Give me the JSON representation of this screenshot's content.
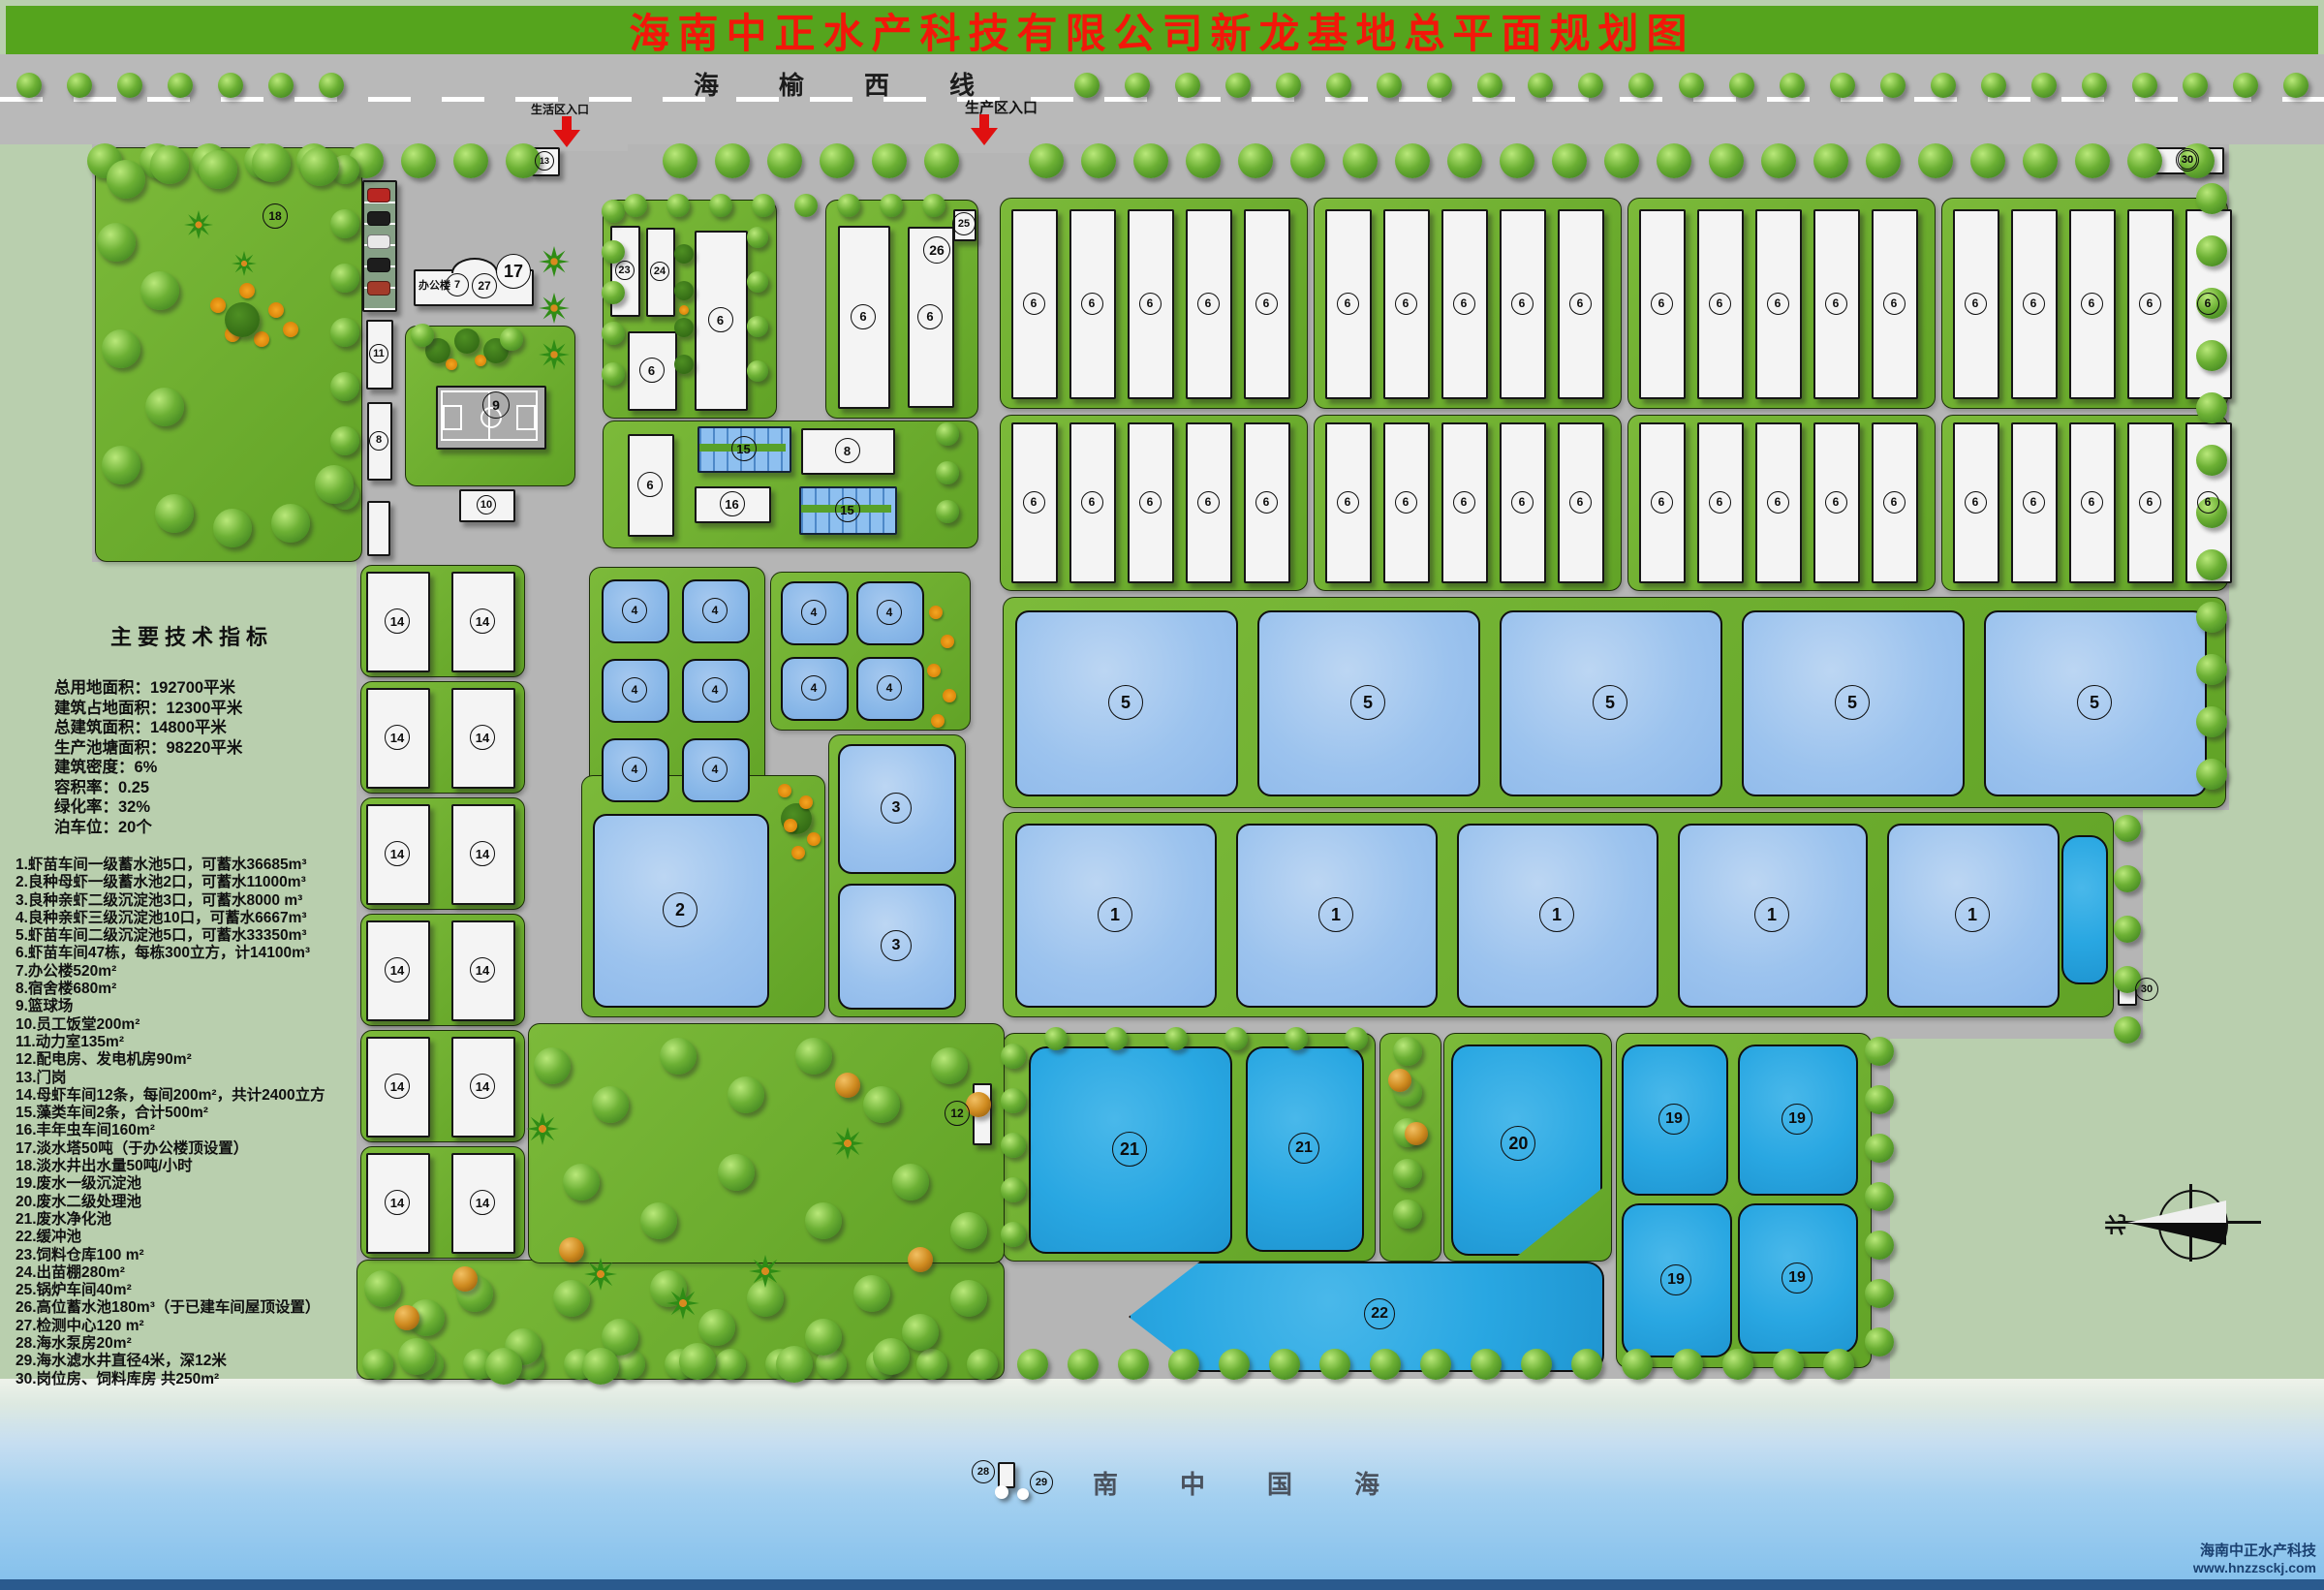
{
  "title": "海南中正水产科技有限公司新龙基地总平面规划图",
  "highway": {
    "name": "海榆西线"
  },
  "entrances": [
    {
      "label": "生活区入口"
    },
    {
      "label": "生产区入口"
    }
  ],
  "indicators": {
    "title": "主要技术指标",
    "lines": [
      "总用地面积：192700平米",
      "建筑占地面积：12300平米",
      "总建筑面积：14800平米",
      "生产池塘面积：98220平米",
      "建筑密度：6%",
      "容积率：0.25",
      "绿化率：32%",
      "泊车位：20个"
    ]
  },
  "legend": [
    "1.虾苗车间一级蓄水池5口，可蓄水36685m³",
    "2.良种母虾一级蓄水池2口，可蓄水11000m³",
    "3.良种亲虾二级沉淀池3口，可蓄水8000 m³",
    "4.良种亲虾三级沉淀池10口，可蓄水6667m³",
    "5.虾苗车间二级沉淀池5口，可蓄水33350m³",
    "6.虾苗车间47栋，每栋300立方，计14100m³",
    "7.办公楼520m²",
    "8.宿舍楼680m²",
    "9.篮球场",
    "10.员工饭堂200m²",
    "11.动力室135m²",
    "12.配电房、发电机房90m²",
    "13.门岗",
    "14.母虾车间12条，每间200m²，共计2400立方",
    "15.藻类车间2条，合计500m²",
    "16.丰年虫车间160m²",
    "17.淡水塔50吨（于办公楼顶设置）",
    "18.淡水井出水量50吨/小时",
    "19.废水一级沉淀池",
    "20.废水二级处理池",
    "21.废水净化池",
    "22.缓冲池",
    "23.饲料仓库100 m²",
    "24.出苗棚280m²",
    "25.锅炉车间40m²",
    "26.高位蓄水池180m³（于已建车间屋顶设置）",
    "27.检测中心120 m²",
    "28.海水泵房20m²",
    "29.海水滤水井直径4米，深12米",
    "30.岗位房、饲料库房 共250m²"
  ],
  "sea_label": "南中国海",
  "compass_label": "北",
  "watermark": {
    "company": "海南中正水产科技",
    "url": "www.hnzzsckj.com"
  },
  "office_text": "办公楼",
  "plan": {
    "islands": [
      [
        98,
        152,
        274,
        426
      ],
      [
        418,
        336,
        174,
        164
      ],
      [
        622,
        206,
        178,
        224
      ],
      [
        852,
        206,
        156,
        224
      ],
      [
        622,
        434,
        386,
        130
      ],
      [
        608,
        585,
        180,
        252
      ],
      [
        795,
        590,
        205,
        162
      ],
      [
        600,
        800,
        250,
        248
      ],
      [
        855,
        758,
        140,
        290
      ],
      [
        1035,
        616,
        1261,
        216
      ],
      [
        1035,
        838,
        1145,
        210
      ],
      [
        1035,
        1066,
        383,
        234
      ],
      [
        1424,
        1066,
        62,
        234
      ],
      [
        1490,
        1066,
        172,
        234
      ],
      [
        1668,
        1066,
        262,
        344
      ],
      [
        368,
        1300,
        667,
        122
      ],
      [
        545,
        1056,
        490,
        246
      ]
    ],
    "workshops": {
      "xs": [
        1032,
        1356,
        1680,
        2004
      ],
      "n": 5,
      "pitch": 60,
      "inset": 12,
      "w": 44,
      "rows": [
        [
          216,
          192
        ],
        [
          436,
          162
        ]
      ],
      "label": "6"
    },
    "grid14": {
      "cols": [
        378,
        466
      ],
      "w": 62,
      "h": 100,
      "rows": [
        590,
        710,
        830,
        950,
        1070,
        1190
      ],
      "label": "14"
    },
    "ponds": [
      [
        621,
        598,
        66,
        62,
        "4",
        "M"
      ],
      [
        704,
        598,
        66,
        62,
        "4",
        "M"
      ],
      [
        621,
        680,
        66,
        62,
        "4",
        "M"
      ],
      [
        704,
        680,
        66,
        62,
        "4",
        "M"
      ],
      [
        621,
        762,
        66,
        62,
        "4",
        "M"
      ],
      [
        704,
        762,
        66,
        62,
        "4",
        "M"
      ],
      [
        806,
        600,
        66,
        62,
        "4",
        "M"
      ],
      [
        884,
        600,
        66,
        62,
        "4",
        "M"
      ],
      [
        806,
        678,
        66,
        62,
        "4",
        "M"
      ],
      [
        884,
        678,
        66,
        62,
        "4",
        "M"
      ],
      [
        612,
        840,
        178,
        196,
        "2",
        "L"
      ],
      [
        865,
        768,
        118,
        130,
        "3",
        "L"
      ],
      [
        865,
        912,
        118,
        126,
        "3",
        "L"
      ],
      [
        1048,
        630,
        226,
        188,
        "5",
        "L"
      ],
      [
        1298,
        630,
        226,
        188,
        "5",
        "L"
      ],
      [
        1548,
        630,
        226,
        188,
        "5",
        "L"
      ],
      [
        1798,
        630,
        226,
        188,
        "5",
        "L"
      ],
      [
        2048,
        630,
        226,
        188,
        "5",
        "L"
      ],
      [
        1048,
        850,
        204,
        186,
        "1",
        "L"
      ],
      [
        1276,
        850,
        204,
        186,
        "1",
        "L"
      ],
      [
        1504,
        850,
        204,
        186,
        "1",
        "L"
      ],
      [
        1732,
        850,
        192,
        186,
        "1",
        "L"
      ],
      [
        1948,
        850,
        174,
        186,
        "1",
        "L"
      ],
      [
        2128,
        862,
        44,
        150,
        "",
        "C"
      ],
      [
        1062,
        1080,
        206,
        210,
        "21",
        "C"
      ],
      [
        1286,
        1080,
        118,
        208,
        "21",
        "C"
      ],
      [
        1498,
        1078,
        152,
        214,
        "20",
        "C",
        "p20"
      ],
      [
        1674,
        1078,
        106,
        152,
        "19",
        "C"
      ],
      [
        1794,
        1078,
        120,
        152,
        "19",
        "C"
      ],
      [
        1674,
        1242,
        110,
        155,
        "19",
        "C"
      ],
      [
        1794,
        1242,
        120,
        151,
        "19",
        "C"
      ],
      [
        1165,
        1302,
        487,
        110,
        "22",
        "C",
        "p22"
      ]
    ],
    "buildings": [
      [
        374,
        186,
        32,
        132,
        "",
        "park"
      ],
      [
        427,
        278,
        120,
        34,
        "",
        "office"
      ],
      [
        378,
        330,
        24,
        68,
        "11"
      ],
      [
        379,
        415,
        22,
        77,
        "8"
      ],
      [
        379,
        517,
        20,
        53,
        ""
      ],
      [
        474,
        505,
        54,
        30,
        "10"
      ],
      [
        450,
        398,
        110,
        62,
        "",
        "court"
      ],
      [
        630,
        233,
        27,
        90,
        "23"
      ],
      [
        667,
        235,
        26,
        88,
        "24"
      ],
      [
        717,
        238,
        51,
        182,
        "6"
      ],
      [
        648,
        342,
        47,
        78,
        "6"
      ],
      [
        865,
        233,
        50,
        185,
        "6"
      ],
      [
        937,
        234,
        44,
        183,
        "6"
      ],
      [
        984,
        216,
        20,
        29,
        ""
      ],
      [
        648,
        448,
        44,
        102,
        "6"
      ],
      [
        720,
        440,
        93,
        44,
        "15",
        "s15"
      ],
      [
        717,
        502,
        75,
        34,
        "16"
      ],
      [
        827,
        442,
        93,
        44,
        "8"
      ],
      [
        825,
        502,
        97,
        46,
        "15",
        "s15"
      ],
      [
        2222,
        152,
        70,
        24,
        "30"
      ],
      [
        2186,
        1006,
        16,
        28,
        ""
      ],
      [
        1004,
        1118,
        16,
        60,
        ""
      ],
      [
        1030,
        1509,
        14,
        23,
        ""
      ],
      [
        549,
        152,
        25,
        26,
        ""
      ]
    ],
    "markers": [
      [
        283,
        222,
        "18",
        24
      ],
      [
        561,
        165,
        "13",
        18
      ],
      [
        471,
        293,
        "7",
        22
      ],
      [
        499,
        294,
        "27",
        24
      ],
      [
        529,
        279,
        "17",
        34,
        1
      ],
      [
        511,
        417,
        "9",
        26
      ],
      [
        966,
        257,
        "26",
        26
      ],
      [
        994,
        230,
        "25",
        22
      ],
      [
        987,
        1148,
        "12",
        24
      ],
      [
        1014,
        1518,
        "28",
        22
      ],
      [
        1074,
        1529,
        "29",
        22
      ],
      [
        2257,
        164,
        "30",
        22
      ],
      [
        2215,
        1020,
        "30",
        22
      ]
    ],
    "dots": [
      [
        1034,
        1540,
        14
      ],
      [
        1056,
        1542,
        12
      ]
    ]
  }
}
